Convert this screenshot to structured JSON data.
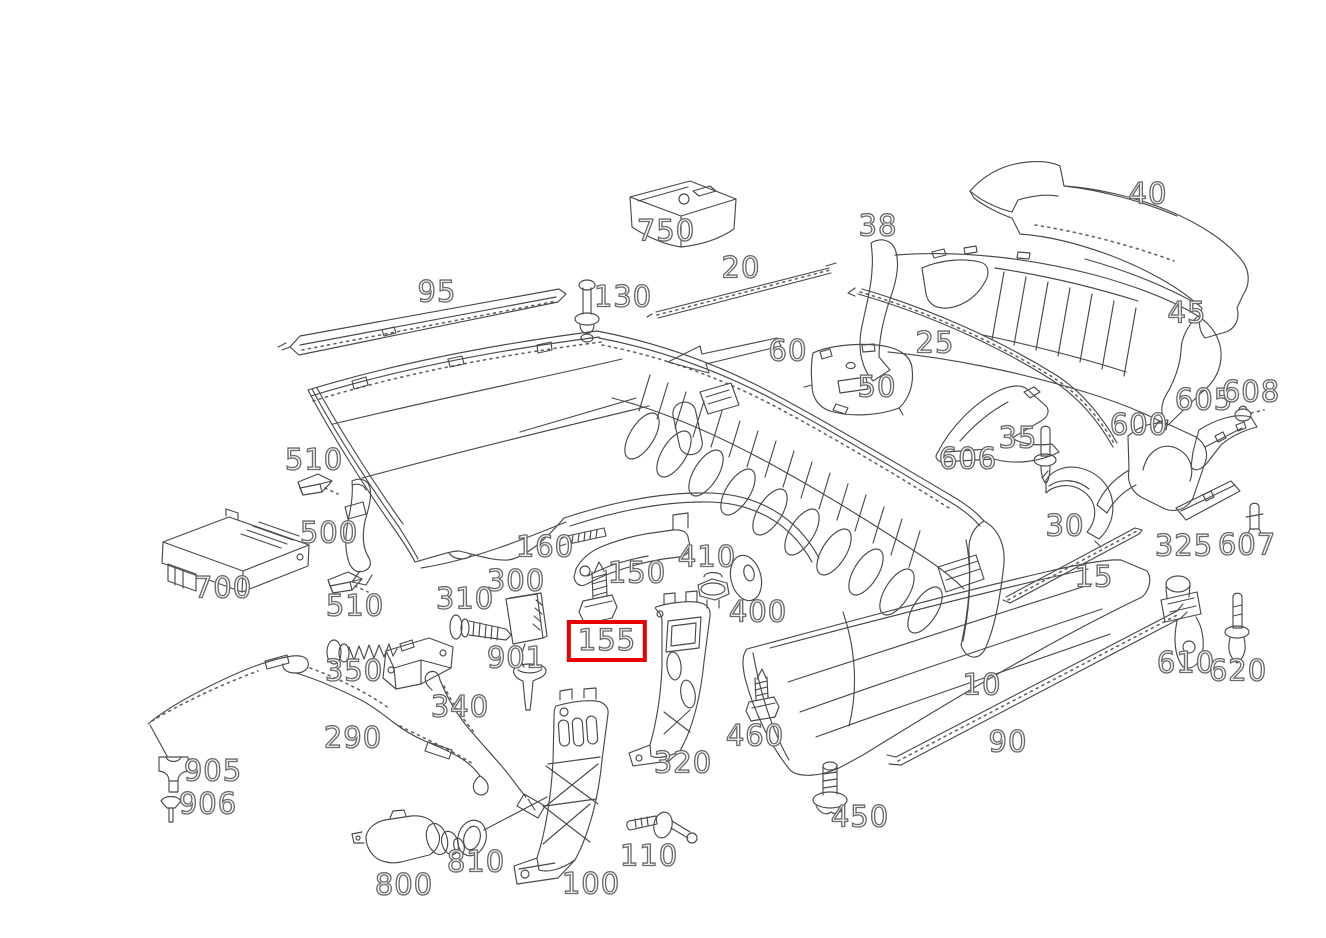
{
  "diagram": {
    "type": "exploded-parts-diagram",
    "subject": "rear bumper assembly",
    "background": "#ffffff",
    "line_color": "#4a4a4a",
    "highlight": {
      "label": "155",
      "color": "#ea0000"
    },
    "labels": [
      {
        "text": "40",
        "x": 1148,
        "y": 194
      },
      {
        "text": "38",
        "x": 878,
        "y": 226
      },
      {
        "text": "45",
        "x": 1187,
        "y": 313
      },
      {
        "text": "25",
        "x": 935,
        "y": 343
      },
      {
        "text": "20",
        "x": 741,
        "y": 268
      },
      {
        "text": "750",
        "x": 666,
        "y": 231
      },
      {
        "text": "95",
        "x": 437,
        "y": 292
      },
      {
        "text": "130",
        "x": 623,
        "y": 297
      },
      {
        "text": "60",
        "x": 788,
        "y": 351
      },
      {
        "text": "50",
        "x": 877,
        "y": 387
      },
      {
        "text": "606",
        "x": 968,
        "y": 459
      },
      {
        "text": "35",
        "x": 1018,
        "y": 438
      },
      {
        "text": "30",
        "x": 1065,
        "y": 526
      },
      {
        "text": "600",
        "x": 1139,
        "y": 425
      },
      {
        "text": "605",
        "x": 1204,
        "y": 400
      },
      {
        "text": "608",
        "x": 1251,
        "y": 392
      },
      {
        "text": "325",
        "x": 1184,
        "y": 546
      },
      {
        "text": "607",
        "x": 1247,
        "y": 545
      },
      {
        "text": "15",
        "x": 1094,
        "y": 577
      },
      {
        "text": "610",
        "x": 1186,
        "y": 663
      },
      {
        "text": "620",
        "x": 1238,
        "y": 671
      },
      {
        "text": "10",
        "x": 982,
        "y": 685
      },
      {
        "text": "90",
        "x": 1008,
        "y": 742
      },
      {
        "text": "450",
        "x": 860,
        "y": 817
      },
      {
        "text": "460",
        "x": 755,
        "y": 736
      },
      {
        "text": "510",
        "x": 314,
        "y": 460,
        "key": "510-upper"
      },
      {
        "text": "500",
        "x": 329,
        "y": 533
      },
      {
        "text": "700",
        "x": 223,
        "y": 588
      },
      {
        "text": "510",
        "x": 355,
        "y": 606,
        "key": "510-lower"
      },
      {
        "text": "300",
        "x": 516,
        "y": 581
      },
      {
        "text": "310",
        "x": 465,
        "y": 599
      },
      {
        "text": "160",
        "x": 545,
        "y": 547
      },
      {
        "text": "150",
        "x": 637,
        "y": 573
      },
      {
        "text": "410",
        "x": 707,
        "y": 557
      },
      {
        "text": "400",
        "x": 758,
        "y": 612
      },
      {
        "text": "155",
        "x": 607,
        "y": 641,
        "highlighted": true
      },
      {
        "text": "901",
        "x": 516,
        "y": 658
      },
      {
        "text": "350",
        "x": 354,
        "y": 671
      },
      {
        "text": "340",
        "x": 460,
        "y": 707
      },
      {
        "text": "290",
        "x": 353,
        "y": 738
      },
      {
        "text": "905",
        "x": 213,
        "y": 771
      },
      {
        "text": "906",
        "x": 208,
        "y": 804
      },
      {
        "text": "800",
        "x": 404,
        "y": 885
      },
      {
        "text": "810",
        "x": 476,
        "y": 862
      },
      {
        "text": "100",
        "x": 591,
        "y": 884
      },
      {
        "text": "110",
        "x": 649,
        "y": 856
      },
      {
        "text": "320",
        "x": 683,
        "y": 763
      }
    ]
  }
}
